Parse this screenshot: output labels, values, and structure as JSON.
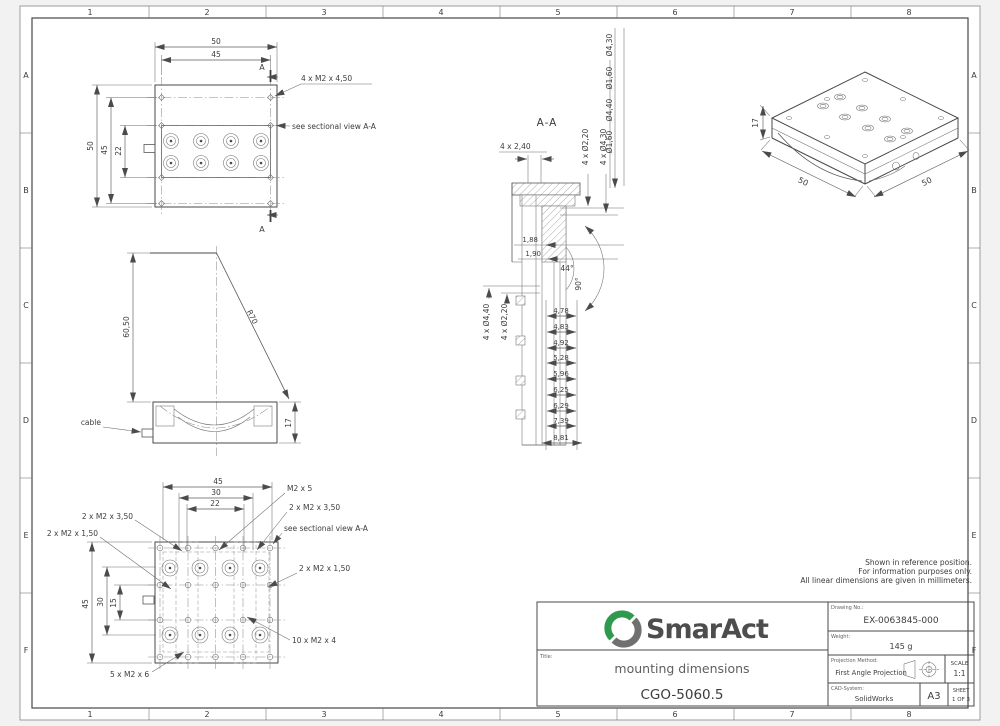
{
  "sheet": {
    "grid_columns": [
      "1",
      "2",
      "3",
      "4",
      "5",
      "6",
      "7",
      "8"
    ],
    "grid_rows": [
      "A",
      "B",
      "C",
      "D",
      "E",
      "F"
    ],
    "notes": [
      "Shown in reference position.",
      "For information purposes only.",
      "All linear dimensions are given in millimeters."
    ]
  },
  "top_view": {
    "dim_width_outer": "50",
    "dim_width_inner": "45",
    "dim_height_outer": "50",
    "dim_height_inner": "45",
    "dim_hole_rows": "22",
    "callout_screws": "4 x M2 x 4,50",
    "callout_section": "see sectional view A-A",
    "section_marker": "A"
  },
  "side_view": {
    "dim_height": "60,50",
    "dim_radius": "R70",
    "dim_base_height": "17",
    "label_cable": "cable"
  },
  "bottom_view": {
    "dim_width_outer": "45",
    "dim_width_mid": "30",
    "dim_width_inner": "22",
    "dim_height_outer": "45",
    "dim_height_mid": "30",
    "dim_height_inner": "15",
    "callout_m2x5": "M2 x 5",
    "callout_m2x350_left": "2 x M2 x 3,50",
    "callout_m2x350_right": "2 x M2 x 3,50",
    "callout_m2x150_left": "2 x M2 x 1,50",
    "callout_m2x150_right": "2 x M2 x 1,50",
    "callout_section": "see sectional view A-A",
    "callout_m2x4": "10 x M2 x 4",
    "callout_m2x6": "5 x M2 x 6"
  },
  "section_view": {
    "title": "A-A",
    "callout_counterbores": "4 x 2,40",
    "dia_labels": [
      "Ø4,30",
      "Ø1,60",
      "Ø4,40",
      "Ø1,60"
    ],
    "callout_right_dia_small": "4 x Ø2,20",
    "callout_right_dia_large": "4 x Ø4,30",
    "callout_left_dia_large": "4 x Ø4,40",
    "callout_left_dia_small": "4 x Ø2,20",
    "dim_a": "1,88",
    "dim_b": "1,90",
    "angle_full": "44°",
    "angle_half": "90°",
    "depth_stack": [
      "4,78",
      "4,83",
      "4,92",
      "5,28",
      "5,96",
      "6,25",
      "6,29",
      "7,39",
      "8,81"
    ]
  },
  "iso_view": {
    "dim_height": "17",
    "dim_width": "50",
    "dim_depth": "50"
  },
  "title_block": {
    "brand": "SmarAct",
    "title_label": "Title:",
    "subject": "mounting dimensions",
    "part_number": "CGO-5060.5",
    "drawing_no_label": "Drawing No.:",
    "drawing_no": "EX-0063845-000",
    "weight_label": "Weight:",
    "weight": "145 g",
    "projection_label": "Projection Method:",
    "projection": "First Angle Projection",
    "cad_label": "CAD-System:",
    "cad_system": "SolidWorks",
    "paper_size": "A3",
    "scale_label": "SCALE",
    "scale_value": "1:1",
    "sheet_label": "SHEET",
    "sheet_value": "1 OF 3"
  },
  "colors": {
    "line": "#4a4a4a",
    "brand_green": "#2f9a4e",
    "brand_gray": "#707070"
  }
}
